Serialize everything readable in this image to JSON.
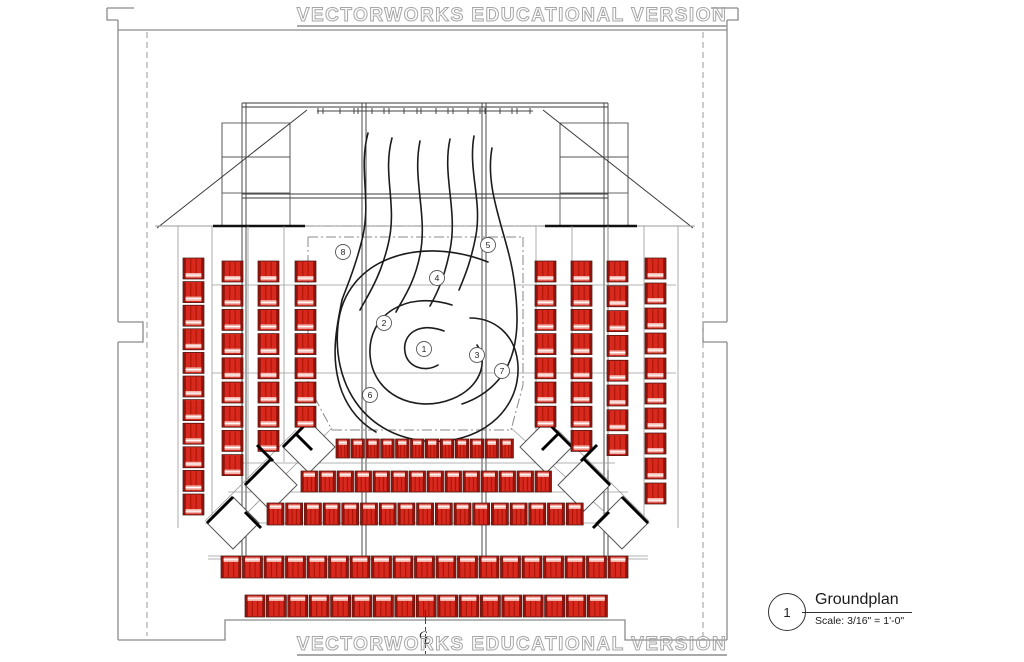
{
  "banner": {
    "top_text": "VECTORWORKS EDUCATIONAL VERSION",
    "bottom_text": "VECTORWORKS EDUCATIONAL VERSION"
  },
  "title_block": {
    "detail_number": "1",
    "title": "Groundplan",
    "scale_note": "Scale: 3/16\" = 1'-0\""
  },
  "centerline": {
    "c": "C",
    "l": "L"
  },
  "colors": {
    "seat_fill": "#d8291f",
    "seat_rail": "#8f130b",
    "seat_stripe": "#b01608",
    "seat_band": "#f3b3ab",
    "seat_band_line": "#ffffff",
    "seat_outline": "#3a0c08",
    "line_dark": "#1c1c1c",
    "line_mid": "#555555",
    "line_gray": "#8a8a8a",
    "dashdot": "#888888",
    "marker_stroke": "#555555",
    "marker_text": "#222222"
  },
  "stage_markers": [
    {
      "label": "1",
      "x": 424,
      "y": 349
    },
    {
      "label": "2",
      "x": 384,
      "y": 323
    },
    {
      "label": "3",
      "x": 477,
      "y": 355
    },
    {
      "label": "4",
      "x": 437,
      "y": 278
    },
    {
      "label": "5",
      "x": 488,
      "y": 245
    },
    {
      "label": "6",
      "x": 370,
      "y": 395
    },
    {
      "label": "7",
      "x": 502,
      "y": 371
    },
    {
      "label": "8",
      "x": 343,
      "y": 252
    }
  ],
  "seating": {
    "seat_w": 21,
    "seat_h": 21,
    "columns": [
      {
        "x": 183,
        "y": 258,
        "count": 11,
        "pitch": 23.6
      },
      {
        "x": 222,
        "y": 261,
        "count": 9,
        "pitch": 24.2
      },
      {
        "x": 258,
        "y": 261,
        "count": 8,
        "pitch": 24.2
      },
      {
        "x": 295,
        "y": 261,
        "count": 7,
        "pitch": 24.2
      },
      {
        "x": 535,
        "y": 261,
        "count": 7,
        "pitch": 24.2
      },
      {
        "x": 571,
        "y": 261,
        "count": 8,
        "pitch": 24.2
      },
      {
        "x": 607,
        "y": 261,
        "count": 8,
        "pitch": 24.8
      },
      {
        "x": 645,
        "y": 258,
        "count": 10,
        "pitch": 25.0
      }
    ],
    "rows": [
      {
        "x": 336,
        "y": 439,
        "count": 12,
        "pitch": 14.9,
        "w": 13.5,
        "h": 19
      },
      {
        "x": 301,
        "y": 471,
        "count": 14,
        "pitch": 18.0,
        "w": 16.5,
        "h": 21
      },
      {
        "x": 267,
        "y": 503,
        "count": 17,
        "pitch": 18.7,
        "w": 17.0,
        "h": 22
      },
      {
        "x": 221,
        "y": 556,
        "count": 19,
        "pitch": 21.5,
        "w": 20.0,
        "h": 22
      },
      {
        "x": 245,
        "y": 595,
        "count": 17,
        "pitch": 21.4,
        "w": 20.0,
        "h": 22
      }
    ]
  },
  "diamonds": {
    "half": 26,
    "left": [
      {
        "x": 309,
        "y": 447
      },
      {
        "x": 271,
        "y": 485
      },
      {
        "x": 233,
        "y": 523
      }
    ],
    "right": [
      {
        "x": 546,
        "y": 447
      },
      {
        "x": 584,
        "y": 485
      },
      {
        "x": 622,
        "y": 523
      }
    ]
  },
  "thick_marks": [
    "M257,445 L273,461",
    "M296,434 L312,450",
    "M245,512 L261,528",
    "M597,445 L581,461",
    "M558,434 L542,450",
    "M609,512 L593,528"
  ],
  "curves": [
    "M368,133 C358,170 372,200 362,240 C354,272 346,288 342,300",
    "M392,138 C382,175 398,205 388,245 C380,278 368,295 360,310",
    "M420,141 C412,180 428,215 420,255 C414,285 402,300 396,312",
    "M450,139 C442,176 458,210 450,250 C444,280 436,295 430,306",
    "M474,136 C468,170 482,200 476,235 C471,262 464,278 459,290",
    "M492,148 C484,192 508,235 514,280 C520,322 518,355 500,378 C488,393 474,400 462,404",
    "M488,262 C420,235 345,258 338,325 C332,382 362,434 424,441 C478,446 520,412 518,366 C516,332 492,318 470,318",
    "M452,305 C405,290 368,316 370,354 C372,394 414,414 452,399 C480,388 489,362 477,345",
    "M444,331 C418,321 402,335 405,352 C407,367 425,373 438,365",
    "M342,300 C336,330 330,360 342,392 C350,412 362,424 376,432"
  ]
}
